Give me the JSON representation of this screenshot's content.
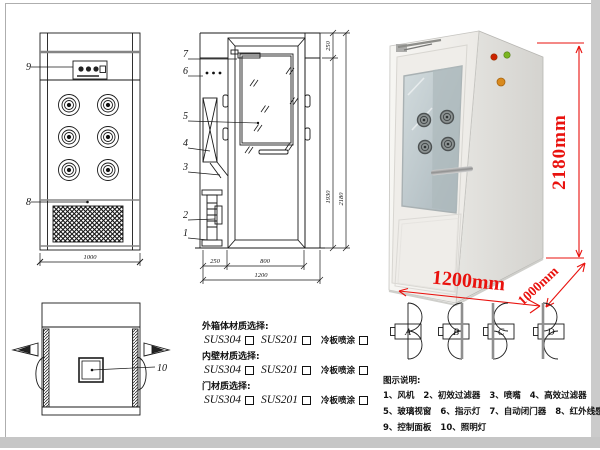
{
  "front_view": {
    "part_control_panel": "9",
    "part_grille": "8",
    "dim_width": "1000"
  },
  "side_view": {
    "parts": {
      "p7": "7",
      "p6": "6",
      "p5": "5",
      "p4": "4",
      "p3": "3",
      "p2": "2",
      "p1": "1"
    },
    "dims": {
      "top_section": "250",
      "door_height": "1930",
      "total_height": "2180",
      "side_depth": "250",
      "door_width": "800",
      "total_width": "1200"
    }
  },
  "top_view": {
    "part_lamp": "10"
  },
  "photo": {
    "dim_height": "2180mm",
    "dim_width": "1200mm",
    "dim_depth": "1000mm",
    "accent_red": "#e9120e",
    "light_colors": {
      "red": "#cc2200",
      "green": "#7ab520",
      "orange": "#d98a1e"
    }
  },
  "materials": {
    "sections": [
      {
        "title": "外箱体材质选择:",
        "opt1": "SUS304",
        "opt2": "SUS201",
        "opt3": "冷板喷涂"
      },
      {
        "title": "内壁材质选择:",
        "opt1": "SUS304",
        "opt2": "SUS201",
        "opt3": "冷板喷涂"
      },
      {
        "title": "门材质选择:",
        "opt1": "SUS304",
        "opt2": "SUS201",
        "opt3": "冷板喷涂"
      }
    ]
  },
  "door_configs": {
    "a": "A",
    "b": "B",
    "c": "C",
    "d": "D"
  },
  "legend": {
    "title": "图示说明:",
    "items": [
      "1、风机",
      "2、初效过滤器",
      "3、喷嘴",
      "4、高效过滤器",
      "5、玻璃视窗",
      "6、指示灯",
      "7、自动闭门器",
      "8、红外线感应器",
      "9、控制面板",
      "10、照明灯"
    ]
  }
}
